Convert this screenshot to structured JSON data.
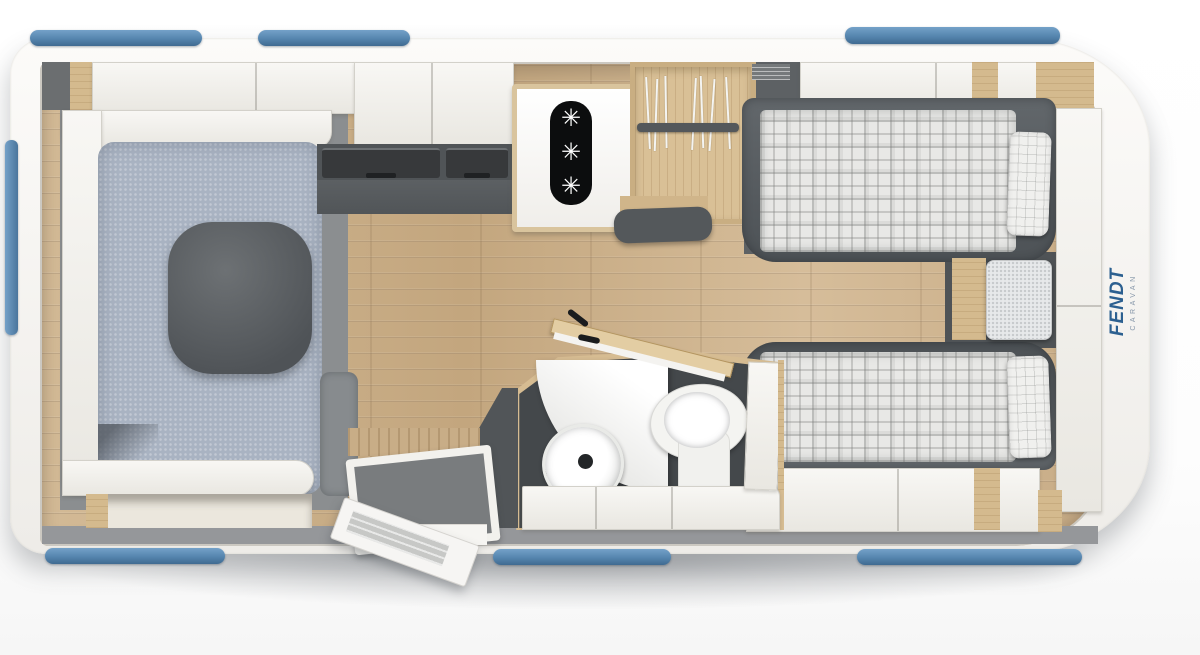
{
  "branding": {
    "logo_main": "FENDT",
    "logo_sub": "CARAVAN",
    "logo_color": "#2c6090"
  },
  "plan": {
    "type": "caravan-floor-plan",
    "view": "top-down",
    "rooms": {
      "lounge": {
        "name": "u-shaped-lounge",
        "furniture": [
          "sofa-cushions",
          "dinette-table",
          "overhead-lockers",
          "under-seat-storage"
        ]
      },
      "kitchen": {
        "name": "kitchen",
        "furniture": [
          "three-burner-hob",
          "worktop-drawers",
          "overhead-lockers"
        ]
      },
      "wardrobe": {
        "name": "wardrobe",
        "furniture": [
          "clothes-rail",
          "hangers",
          "stool"
        ]
      },
      "bathroom": {
        "name": "washroom",
        "furniture": [
          "washbasin",
          "toilet",
          "shower-tray",
          "bench",
          "swing-door"
        ]
      },
      "bedroom": {
        "name": "twin-single-beds",
        "furniture": [
          "bed-top",
          "bed-bottom",
          "pillows",
          "nightstand",
          "front-wardrobe",
          "overhead-lockers"
        ]
      },
      "entrance": {
        "name": "entrance",
        "furniture": [
          "entry-door-open",
          "step-mat"
        ]
      }
    },
    "windows": {
      "top": 3,
      "bottom": 3,
      "rear": 1
    }
  },
  "kitchen": {
    "hob": {
      "burner_glyph": "✳",
      "burners": 3
    }
  },
  "palette": {
    "body_white": "#f8f7f4",
    "window_blue": "#5585ae",
    "floor_wood": "#ccb28c",
    "floor_grey": "#95979a",
    "cushion_blue": "#a9b3c2",
    "table_grey": "#565a5d",
    "bed_frame_grey": "#565b5f",
    "wood_trim": "#d8c199",
    "hob_black": "#0c0d0e"
  }
}
